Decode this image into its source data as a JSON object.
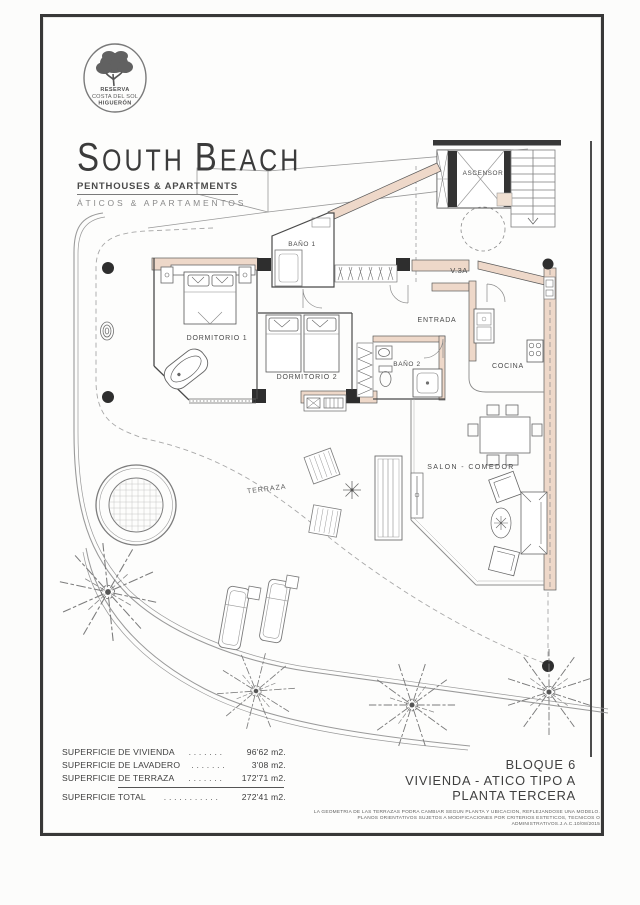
{
  "logo": {
    "line1": "RESERVA",
    "line2": "COSTA DEL SOL",
    "line3": "HIGUERÓN"
  },
  "brand": {
    "word1_initial": "S",
    "word1_rest": "OUTH",
    "word2_initial": "B",
    "word2_rest": "EACH",
    "subtitle_en": "PENTHOUSES & APARTMENTS",
    "subtitle_es": "ÁTICOS & APARTAMENTOS"
  },
  "plan": {
    "rooms": {
      "bano1": "BAÑO 1",
      "entrada": "ENTRADA",
      "v3a": "V.3A",
      "ascensor": "ASCENSOR",
      "dormitorio1": "DORMITORIO 1",
      "dormitorio2": "DORMITORIO 2",
      "bano2": "BAÑO 2",
      "cocina": "COCINA",
      "salon": "SALON - COMEDOR",
      "terraza": "TERRAZA"
    }
  },
  "areas": {
    "rows": [
      {
        "label": "SUPERFICIE DE VIVIENDA",
        "dots": ". . . . . . .",
        "value": "96'62 m2."
      },
      {
        "label": "SUPERFICIE DE LAVADERO",
        "dots": ". . . . . . .",
        "value": "3'08 m2."
      },
      {
        "label": "SUPERFICIE DE TERRAZA",
        "dots": ". . . . . . .",
        "value": "172'71 m2."
      },
      {
        "label": "SUPERFICIE TOTAL",
        "dots": ". . . . . . . . . . .",
        "value": "272'41 m2."
      }
    ]
  },
  "title_block": {
    "line1": "BLOQUE 6",
    "line2": "VIVIENDA - ATICO TIPO A",
    "line3": "PLANTA TERCERA"
  },
  "disclaimer": {
    "line1": "LA GEOMETRIA DE LAS TERRAZAS PODRA CAMBIAR SEGUN PLANTA Y UBICACION, REFLEJANDOSE UNA MODELO.",
    "line2": "PLANOS ORIENTATIVOS SUJETOS A MODIFICACIONES POR CRITERIOS ESTETICOS, TECNICOS O ADMINISTRATIVOS.J.A.C.10/08/2015"
  },
  "colors": {
    "wall_fill": "#eed8c9",
    "line_dark": "#3c3c3c",
    "line_gray": "#8f8f8f",
    "text": "#474747"
  }
}
